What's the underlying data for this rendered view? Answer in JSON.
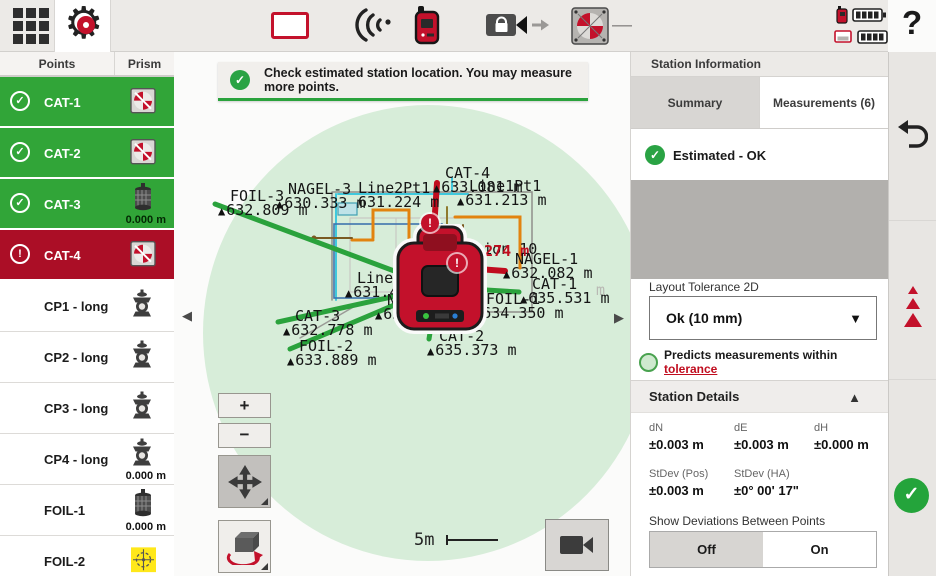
{
  "topbar": {
    "dash": "—",
    "help": "?"
  },
  "sidebar": {
    "col_points": "Points",
    "col_prism": "Prism",
    "items": [
      {
        "label": "CAT-1",
        "state": "ok",
        "prism": "target",
        "value": ""
      },
      {
        "label": "CAT-2",
        "state": "ok",
        "prism": "target",
        "value": ""
      },
      {
        "label": "CAT-3",
        "state": "ok",
        "prism": "prism360",
        "value": "0.000 m"
      },
      {
        "label": "CAT-4",
        "state": "error",
        "prism": "target",
        "value": ""
      },
      {
        "label": "CP1 - long",
        "state": "",
        "prism": "pole",
        "value": ""
      },
      {
        "label": "CP2 - long",
        "state": "",
        "prism": "pole",
        "value": ""
      },
      {
        "label": "CP3 - long",
        "state": "",
        "prism": "pole",
        "value": ""
      },
      {
        "label": "CP4 - long",
        "state": "",
        "prism": "pole",
        "value": "0.000 m"
      },
      {
        "label": "FOIL-1",
        "state": "",
        "prism": "prism360",
        "value": "0.000 m"
      },
      {
        "label": "FOIL-2",
        "state": "",
        "prism": "yellow",
        "value": ""
      }
    ]
  },
  "map": {
    "banner": "Check estimated station location. You may measure more points.",
    "zoom_in": "+",
    "zoom_out": "−",
    "scale_label": "5m",
    "collapse_left": "◀",
    "collapse_right": "▶",
    "labels": [
      {
        "name": "FOIL-3",
        "value": "632.809 m",
        "x": 218,
        "y": 189
      },
      {
        "name": "NAGEL-3",
        "value": "630.333 m",
        "x": 276,
        "y": 182
      },
      {
        "name": "Line2Pt1",
        "value": "631.224 m",
        "x": 346,
        "y": 181,
        "marker": false
      },
      {
        "name": "CAT-4",
        "value": "633.081 m",
        "x": 433,
        "y": 166
      },
      {
        "name": "Line1Pt1",
        "value": "631.213 m",
        "x": 457,
        "y": 179
      },
      {
        "name": "Station 10",
        "value": "",
        "x": 435,
        "y": 242,
        "marker": false
      },
      {
        "name": "",
        "value": "630.274 m",
        "x": 436,
        "y": 244,
        "marker": false,
        "red": true
      },
      {
        "name": "NAGEL-1",
        "value": "632.082 m",
        "x": 503,
        "y": 252
      },
      {
        "name": "CAT-1",
        "value": "635.531 m",
        "x": 520,
        "y": 277
      },
      {
        "name": "FOIL-1",
        "value": "634.350 m",
        "x": 474,
        "y": 292
      },
      {
        "name": "NAGEL-2",
        "value": "630.642 m",
        "x": 375,
        "y": 293
      },
      {
        "name": "CAT-2",
        "value": "635.373 m",
        "x": 427,
        "y": 329
      },
      {
        "name": "CAT-3",
        "value": "632.778 m",
        "x": 283,
        "y": 309
      },
      {
        "name": "FOIL-2",
        "value": "633.889 m",
        "x": 287,
        "y": 339
      },
      {
        "name": "Line2Pt2",
        "value": "631.4",
        "x": 345,
        "y": 271
      },
      {
        "name": "",
        "value": "m",
        "x": 584,
        "y": 283,
        "marker": false,
        "faint": true
      }
    ],
    "green_lines": [
      [
        437,
        287,
        215,
        204
      ],
      [
        437,
        287,
        278,
        322
      ],
      [
        437,
        287,
        290,
        349
      ],
      [
        436,
        295,
        429,
        339
      ],
      [
        437,
        287,
        519,
        292
      ]
    ],
    "red_lines": [
      [
        432,
        258,
        437,
        183
      ],
      [
        437,
        266,
        505,
        271
      ]
    ],
    "badges": [
      [
        421,
        214
      ],
      [
        448,
        254
      ]
    ]
  },
  "panel": {
    "title": "Station Information",
    "tab_summary": "Summary",
    "tab_measurements": "Measurements (6)",
    "status": "Estimated - OK",
    "tolerance_label": "Layout Tolerance 2D",
    "tolerance_value": "Ok (10 mm)",
    "predicts_text": "Predicts measurements within ",
    "predicts_link": "tolerance",
    "details_title": "Station Details",
    "details": [
      {
        "label": "dN",
        "value": "±0.003 m"
      },
      {
        "label": "dE",
        "value": "±0.003 m"
      },
      {
        "label": "dH",
        "value": "±0.000 m"
      },
      {
        "label": "StDev (Pos)",
        "value": "±0.003 m"
      },
      {
        "label": "StDev (HA)",
        "value": "±0° 00' 17\""
      }
    ],
    "deviations_label": "Show Deviations Between Points",
    "toggle_off": "Off",
    "toggle_on": "On"
  },
  "colors": {
    "green": "#2aa23c",
    "red": "#c00c1e",
    "row_green": "#31a538",
    "row_red": "#ab0e26",
    "brand_red": "#c3112b"
  }
}
